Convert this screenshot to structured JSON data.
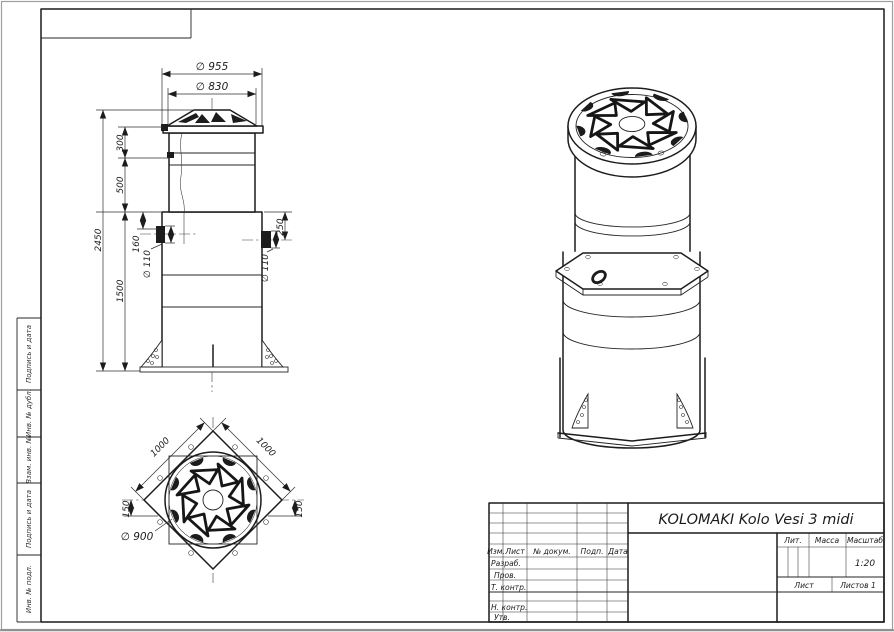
{
  "title_block": {
    "title": "KOLOMAKI Kolo Vesi 3 midi",
    "headers": {
      "izm": "Изм.",
      "list": "Лист",
      "ndokum": "№ докум.",
      "podp": "Подп.",
      "data": "Дата"
    },
    "roles": {
      "razrab": "Разраб.",
      "prov": "Пров.",
      "tkontr": "Т. контр.",
      "nkontr": "Н. контр.",
      "utv": "Утв."
    },
    "right": {
      "lit": "Лит.",
      "massa": "Масса",
      "masshtab": "Масштаб",
      "scale_value": "1:20",
      "sheet": "Лист",
      "sheets": "Листов 1"
    }
  },
  "margin_strip": {
    "items": [
      "Подпись и дата",
      "Инв. № дубл.",
      "Взам. инв. №",
      "Подпись и дата",
      "Инв. № подл."
    ]
  },
  "front_view": {
    "dims": {
      "d955": "∅ 955",
      "d830": "∅ 830",
      "h300": "300",
      "h500": "500",
      "h2450": "2450",
      "h160": "160",
      "d110_left": "∅ 110",
      "h1500": "1500",
      "h250": "250",
      "d110_right": "∅ 110"
    }
  },
  "plan_view": {
    "dims": {
      "side_left": "1000",
      "side_right": "1000",
      "off_left": "150",
      "off_right": "150",
      "d900": "∅ 900"
    }
  }
}
